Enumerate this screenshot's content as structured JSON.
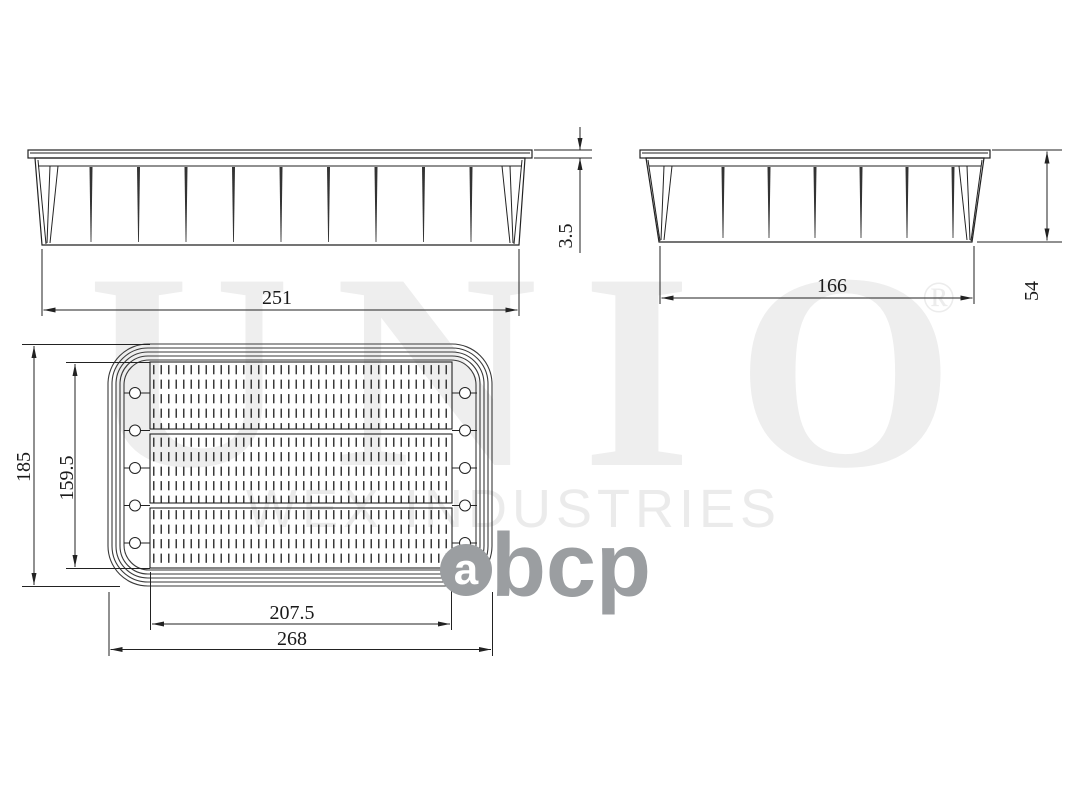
{
  "watermark": {
    "brand": "UNIO",
    "registered_mark": "®",
    "company": "WEX INDUSTRIES",
    "brand_color": "#eeeeee",
    "company_color": "#ebebeb"
  },
  "logo": {
    "first_letter": "a",
    "rest": "bcp",
    "color": "#9b9ea1"
  },
  "drawing": {
    "line_color": "#222222",
    "frame_color": "#3a3a3a",
    "text_color": "#1a1a1a"
  },
  "dimensions": {
    "front_bottom_width": "251",
    "lip_thickness": "3.5",
    "side_bottom_width": "166",
    "overall_height": "54",
    "plan_outer_height": "185",
    "plan_inner_height": "159.5",
    "plan_inner_width": "207.5",
    "plan_outer_width": "268"
  }
}
